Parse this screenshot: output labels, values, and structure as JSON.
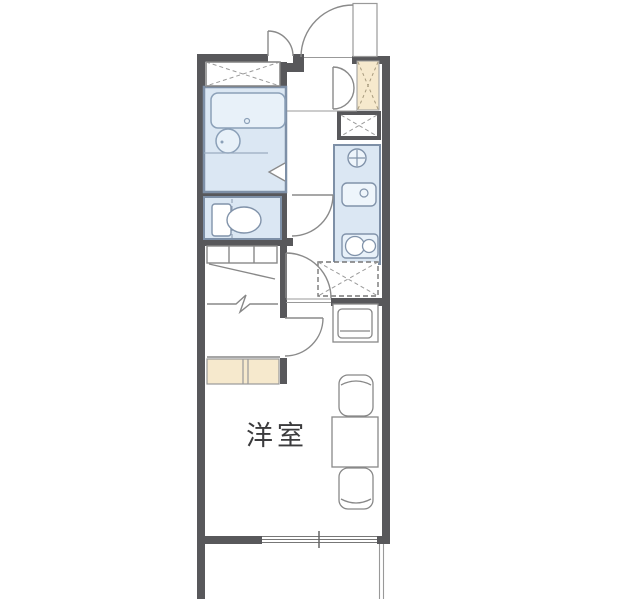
{
  "floorplan": {
    "room_label": "洋室",
    "colors": {
      "wall": "#58585b",
      "wet_area_fill": "#dbe7f3",
      "wet_area_border": "#7e90a7",
      "fixture_fill": "#e8f1f9",
      "storage_fill": "#f6e9cd",
      "line": "#888888",
      "text": "#3b3b3d",
      "background": "#ffffff"
    },
    "areas": [
      {
        "name": "western-room",
        "label": "洋室"
      },
      {
        "name": "bathroom"
      },
      {
        "name": "toilet"
      },
      {
        "name": "kitchen"
      },
      {
        "name": "closet"
      },
      {
        "name": "entrance"
      },
      {
        "name": "balcony"
      }
    ],
    "fixtures": [
      "bathtub",
      "wash-basin",
      "toilet-bowl",
      "kitchen-sink",
      "burner-icon",
      "two-burner-stove",
      "refrigerator-space",
      "washing-machine-space",
      "shoe-cabinet",
      "storage-shelf",
      "closet-shelf",
      "hanger-pipe",
      "tv-stand",
      "dining-table",
      "chair",
      "chair",
      "sliding-window",
      "entrance-door",
      "room-door",
      "toilet-door",
      "folding-bath-door"
    ]
  }
}
